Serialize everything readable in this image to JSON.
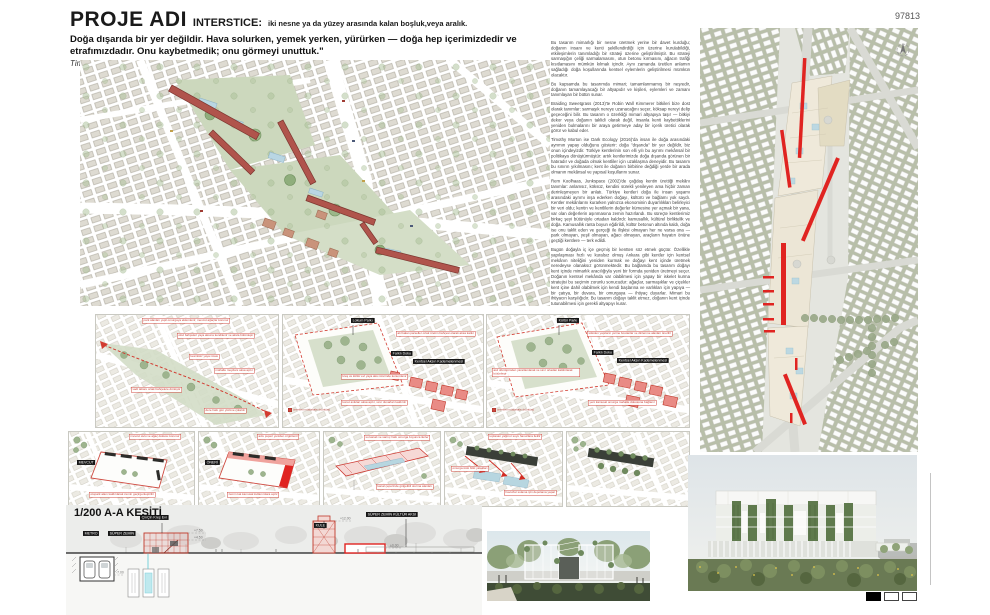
{
  "board": {
    "number": "97813"
  },
  "header": {
    "project_label": "PROJE ADI",
    "term": "INTERSTICE:",
    "term_definition": "iki nesne ya da yüzey arasında kalan boşluk,veya aralık.",
    "quote": "Doğa dışarıda bir yer değildir. Hava solurken, yemek yerken, yürürken — doğa hep içerimizdedir ve etrafımızdadır. Onu kaybetmedik; onu görmeyi unuttuk.\"",
    "quote_source": "Timothy Morton, Dark Ecology, 2016"
  },
  "essay": {
    "paragraphs": [
      "Bu tasarım mimarlığı bir nesne üretmek yerine bir davet kurduğu; doğanın insanı ve kenti şekillendirdiği için üzerine kurulabildiği, etkileşimlerin tanımladığı bir strateji üzerine geliştirilmiştir. Bu strateji sarmaşığın çeliği sarmalamasını, otun betonu kırmasını, ağacın trafiği kısıtlamasını mümkün kılmak içindir. Aynı zamanda üretilen anlamın sağladığı doğa koşullarında kentsel eylemlerin geliştirilmesi mümkün olacaktır.",
      "Bu kapsamda bu tasarımda mimari; tamamlanmamış bir neşredir, doğanın tamamlayacağı bir altyapıdır ve kişileri, eylemleri ve zamanı tanımlayan bir bütün sunar.",
      "Braiding Sweetgrass (2013)'te Robin Wall Kimmerer bitkileri bize dost olarak tanımlar: sarmaşık nereye uzanacağını seçer, köksap nereyi delip geçeceğini bilir. Bu tasarım o özerkliği mimari altyapıya taşır — bitkiyi dekor veya doğanın taklidi olarak değil, insanla kenti kaybettiklerini yeniden bulmalarını bir araya getirmeye aday bir içerik üretici olarak görür ve kabul eder.",
      "Timothy Morton ise Dark Ecology (2016)'da insan ile doğa arasındaki ayrımın yapay olduğunu gösterir: doğa \"dışarıda\" bir yer değildir, biz onun içindeyizdir. Türkiye kentlerinin son elli yılı bu ayrımı mekânsal bir politikaya dönüştürmüştür: artık kentlerimizde doğa dışarıda görünen bir hatıradır ve doğada olmak kentliler için uzaklaşma deneyidir. Bu tasarım bu sınırın yıkılmasını; kent ile doğanın birbirine değdiği yerde bir arada olmanın mekânsal ve yapısal koşullarını sunar.",
      "Rem Koolhaas, Junkspace (2002)'de çağdaş kentin ürettiği mekânı tanımlar: anlamsız, köksüz, kendini sürekli yenileyen ama hiçbir zaman derinleşmeyen bir anlatı. Türkiye kentleri doğa ile insan yaşamı arasındaki ayrımı inşa ederken doğayı, kültürü ve bağlamı yok saydı. Kentler mekânlarını kurarken yalnızca ekonominin duyarlılıkları belirleyici bir veri oldu; kentin ve kentlilerin değerler kümesine yer açmak bir yana, var olan değerlerin aşınmasına zemin hazırlandı. Bu süreçte kentlerimiz birkaç şeyi bütünüyle ortadan kaldırdı: kamusallık, kültürel birliktelik ve doğa. Kamusallık ranta boyun eğdirildi, kültür betonun altında kaldı, doğa ise onu taklit eden ve gerçeği ile ilişkisi olmayan her ne varsa ona — park olmayan, yeşil olmayan, ağacı olmayan, araçların hayatın önüne geçtiği kentlere — terk edildi.",
      "Bugün doğayla iç içe geçmiş bir kentten söz etmek güçtür. Özellikle yapılaşması hızlı ve kuralsız olmuş Ankara gibi kentler için kentsel mekânın niteliğini yeniden kurmak ve doğayı kent içinde üretmek neredeyse olanaksız görünmektedir. Bu bağlamda bu tasarım doğayı kent içinde mimarlık aracılığıyla yeni bir formda yeniden üretmeyi seçer. Doğanın kentsel mekânda var olabilmesi için yapay bir iskelet kurma stratejisi bu seçimin zorunlu sonucudur: ağaçlar, sarmaşıklar ve çiçekler kent içine dahil olabilmek için kendi başlarına ve varlıkları için yapıya — bir çatıya, bir duvara, bir omurgaya — ihtiyaç duyarlar. Mimari bu ihtiyacın karşılığıdır. Bu tasarım doğayı taklit etmez, doğanın kent içinde tutunabilmesi için gerekli altyapıyı kurar."
    ]
  },
  "diagrams": {
    "row1": {
      "panels": [
        {
          "annotations": [
            "park alanları yeşil omurgaya eklemlenir, mevcut ağaçlar korunur",
            "okul bahçeleri yaya aksına kendilenir ve aksla bütünleşir",
            "kesintisiz yaya rotası",
            "vadi tabanı ortak bahçelere dönüşür",
            "mahalle meydanı aksa açılır",
            "dere hattı gün yüzüne çıkarılır"
          ],
          "legend": ""
        },
        {
          "tag": "Lokum Parkı",
          "inner_tag": "Farklı Doku",
          "inner_tag2": "Kentsel Aksın Kademelenmesi",
          "annotations": [
            "atıl kalan parseller ortak üretim bahçesi olarak aksa katılır",
            "kreş ve kültür evi yaya aksı üzerinde konumlanır",
            "konut avluları aksa açılır, sınır duvarları kaldırılır"
          ],
          "legend": "önerilen müdahale örüntüsü"
        },
        {
          "tag": "Kültür Parkı",
          "inner_tag": "Farklı Doku",
          "inner_tag2": "Kentsel Aksın Kademelenmesi",
          "annotations": [
            "sökülen yapıların yerine bostanlar ve dinlenme alanları önerilir",
            "asıl dönüşümden yararlanılarak ve sınır ortadan kaldırılarak bütünleşir",
            "yeni kamusal omurga mahalle dokusuna bağlanır"
          ],
          "legend": "önerilen müdahale örüntüsü"
        }
      ]
    },
    "row2": {
      "panels": [
        {
          "tag": "MEVCUT",
          "annotations": [
            "mevcut avlu ve ağaç dokusu korunur",
            "otopark alanı kaldırılarak zemin geçirgenleştirilir"
          ]
        },
        {
          "tag": "ÖNERİ",
          "annotations": [
            "avlu çeperi yeniden örgütlenir",
            "zemin kat kamusal kullanımlara açılır"
          ]
        },
        {
          "annotations": [
            "su kanalı ve sarnıç hattı omurga boyunca ilerler",
            "kanal çeperinde gölgelikli oturma alanları"
          ]
        },
        {
          "annotations": [
            "toplanan yağmur suyu havuzlara iletilir",
            "omurga üstü bitki yatakları",
            "havuzlar sulama için depolama yapar"
          ]
        },
        {
          "annotations": []
        }
      ]
    }
  },
  "section": {
    "title": "1/200 A-A KESİTİ",
    "tags": {
      "metro": "METRO",
      "super_zemin": "SÜPER ZEMİN",
      "kres": "ÇinÇin Kreş Evi",
      "kule": "KULE",
      "kultur": "SÜPER ZEMİN KÜLTÜR AKSI"
    },
    "levels": {
      "l1": "+4.50",
      "l2": "+7.50",
      "l3": "+12.00",
      "l4": "±0.00",
      "l5": "-7.00"
    }
  },
  "pagination": {
    "note": "pafta 1/3"
  }
}
